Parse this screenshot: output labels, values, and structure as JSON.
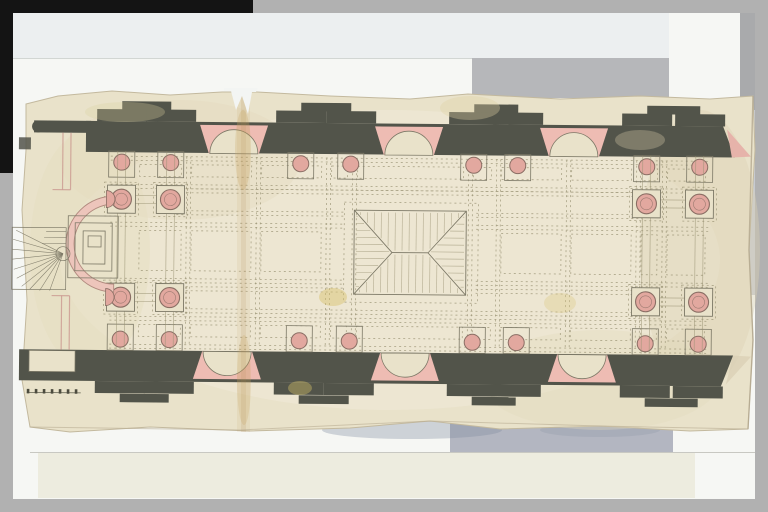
{
  "colors": {
    "frame_gray": "#b1b1b1",
    "frame_black": "#141414",
    "mat_white": "#f6f7f4",
    "gray_band_top": "#b6b7ba",
    "gray_band_bottom": "#b3b6c1",
    "cream_sheet": "#edecdf",
    "paper": "#e9e2ca",
    "paper_light": "#f0ead8",
    "paper_edge": "#c3b99e",
    "wall": "#52544a",
    "pink_niche": "#eebcb3",
    "pink_col": "#e2a89f",
    "pink_apse": "#edc5bb",
    "pink_wall": "#e6b3aa",
    "ink": "#7c7866",
    "ink_faint": "#999273",
    "ring": "#8a6e64",
    "ring2": "#b08a7e"
  },
  "plan": {
    "tilt": 0.5,
    "outline": [
      [
        26,
        104
      ],
      [
        58,
        96
      ],
      [
        112,
        91
      ],
      [
        170,
        95
      ],
      [
        222,
        92
      ],
      [
        257,
        92
      ],
      [
        330,
        96
      ],
      [
        410,
        99
      ],
      [
        468,
        94
      ],
      [
        560,
        99
      ],
      [
        640,
        96
      ],
      [
        710,
        99
      ],
      [
        753,
        96
      ],
      [
        755,
        150
      ],
      [
        749,
        250
      ],
      [
        753,
        340
      ],
      [
        748,
        429
      ],
      [
        690,
        431
      ],
      [
        600,
        426
      ],
      [
        500,
        429
      ],
      [
        430,
        421
      ],
      [
        350,
        428
      ],
      [
        250,
        431
      ],
      [
        150,
        427
      ],
      [
        70,
        432
      ],
      [
        30,
        427
      ],
      [
        22,
        380
      ],
      [
        27,
        300
      ],
      [
        22,
        210
      ],
      [
        26,
        150
      ]
    ],
    "tones": [
      [
        390,
        260,
        330,
        150,
        "#f0ead8",
        0.55
      ],
      [
        180,
        160,
        120,
        60,
        "#e3dabd",
        0.4
      ],
      [
        600,
        380,
        120,
        50,
        "#e3dabd",
        0.35
      ],
      [
        700,
        250,
        60,
        140,
        "#ddd3b4",
        0.4
      ],
      [
        90,
        250,
        60,
        120,
        "#e6debf",
        0.5
      ]
    ],
    "grid": {
      "xs": [
        186,
        256,
        326,
        352,
        468,
        496,
        566,
        636,
        662
      ],
      "ys": [
        156,
        184,
        222,
        278,
        316,
        344
      ],
      "rails": [
        188,
        210,
        286,
        308
      ],
      "cell_xs": [
        134,
        186,
        256,
        326,
        352,
        468,
        496,
        566,
        636,
        662,
        710
      ],
      "bands": [
        [
          160,
          180
        ],
        [
          226,
          274
        ],
        [
          320,
          340
        ]
      ]
    },
    "feature": {
      "x": 354,
      "y": 208,
      "w": 112,
      "h": 84,
      "ax1": 392,
      "ax2": 428
    },
    "pilasters": [
      121,
      170,
      300,
      350,
      473,
      517,
      646,
      699
    ],
    "pairs": [
      [
        121,
        170
      ],
      [
        300,
        350
      ],
      [
        473,
        517
      ],
      [
        646,
        699
      ]
    ],
    "niches_top": [
      233,
      408,
      573
    ],
    "niches_bottom": [
      228,
      406,
      583
    ],
    "columns": [
      [
        121,
        199
      ],
      [
        170,
        199
      ],
      [
        121,
        297
      ],
      [
        170,
        297
      ],
      [
        646,
        199
      ],
      [
        699,
        199
      ],
      [
        646,
        297
      ],
      [
        699,
        297
      ]
    ],
    "cluster_cols": [
      121,
      170,
      646,
      699
    ],
    "rows": [
      199,
      297
    ],
    "stair_rays": [
      [
        16,
        231
      ],
      [
        13,
        240
      ],
      [
        12,
        250
      ],
      [
        12,
        260
      ],
      [
        14,
        270
      ],
      [
        17,
        279
      ],
      [
        22,
        287
      ],
      [
        30,
        290
      ],
      [
        40,
        291
      ],
      [
        50,
        291
      ]
    ],
    "stair_steps": [
      [
        46,
        232,
        66,
        232
      ],
      [
        44,
        238,
        66,
        238
      ],
      [
        42,
        244,
        66,
        244
      ]
    ],
    "stains": [
      [
        333,
        297,
        14,
        9,
        "#d8c26a",
        0.45
      ],
      [
        560,
        303,
        16,
        10,
        "#ddc985",
        0.35
      ],
      [
        300,
        388,
        12,
        7,
        "#d8c26a",
        0.4
      ],
      [
        470,
        108,
        30,
        12,
        "#e0d1a4",
        0.35
      ],
      [
        640,
        140,
        25,
        10,
        "#e5d8b2",
        0.3
      ],
      [
        125,
        112,
        40,
        10,
        "#dccf9f",
        0.3
      ],
      [
        243,
        150,
        8,
        40,
        "#c9a25e",
        0.25
      ],
      [
        244,
        380,
        7,
        45,
        "#c9a25e",
        0.22
      ]
    ],
    "fold_x": 237,
    "tear": [
      [
        224,
        88
      ],
      [
        258,
        88
      ],
      [
        256,
        92
      ],
      [
        252,
        92
      ],
      [
        248,
        114
      ],
      [
        242,
        96
      ],
      [
        236,
        110
      ],
      [
        231,
        91
      ],
      [
        224,
        91
      ]
    ]
  }
}
